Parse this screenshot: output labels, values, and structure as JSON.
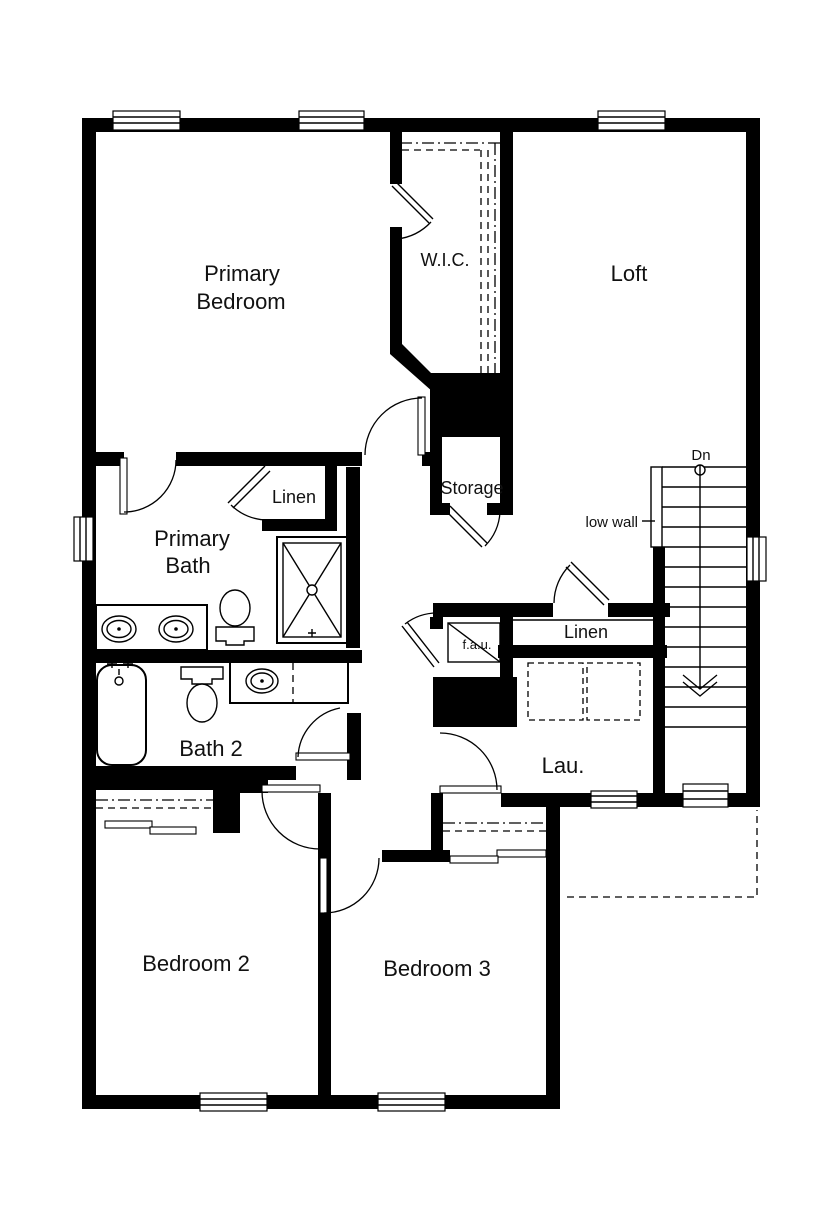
{
  "floor_plan": {
    "rooms": {
      "primary_bedroom": {
        "line1": "Primary",
        "line2": "Bedroom"
      },
      "wic": {
        "label": "W.I.C."
      },
      "loft": {
        "label": "Loft"
      },
      "storage": {
        "label": "Storage"
      },
      "linen_bath": {
        "label": "Linen"
      },
      "primary_bath": {
        "line1": "Primary",
        "line2": "Bath"
      },
      "bath2": {
        "label": "Bath 2"
      },
      "fau": {
        "label": "f.a.u."
      },
      "linen_hall": {
        "label": "Linen"
      },
      "laundry": {
        "label": "Lau."
      },
      "bedroom2": {
        "label": "Bedroom 2"
      },
      "bedroom3": {
        "label": "Bedroom 3"
      }
    },
    "stairs": {
      "direction_label": "Dn",
      "low_wall_label": "low wall"
    },
    "colors": {
      "wall": "#000000",
      "background": "#ffffff"
    }
  }
}
